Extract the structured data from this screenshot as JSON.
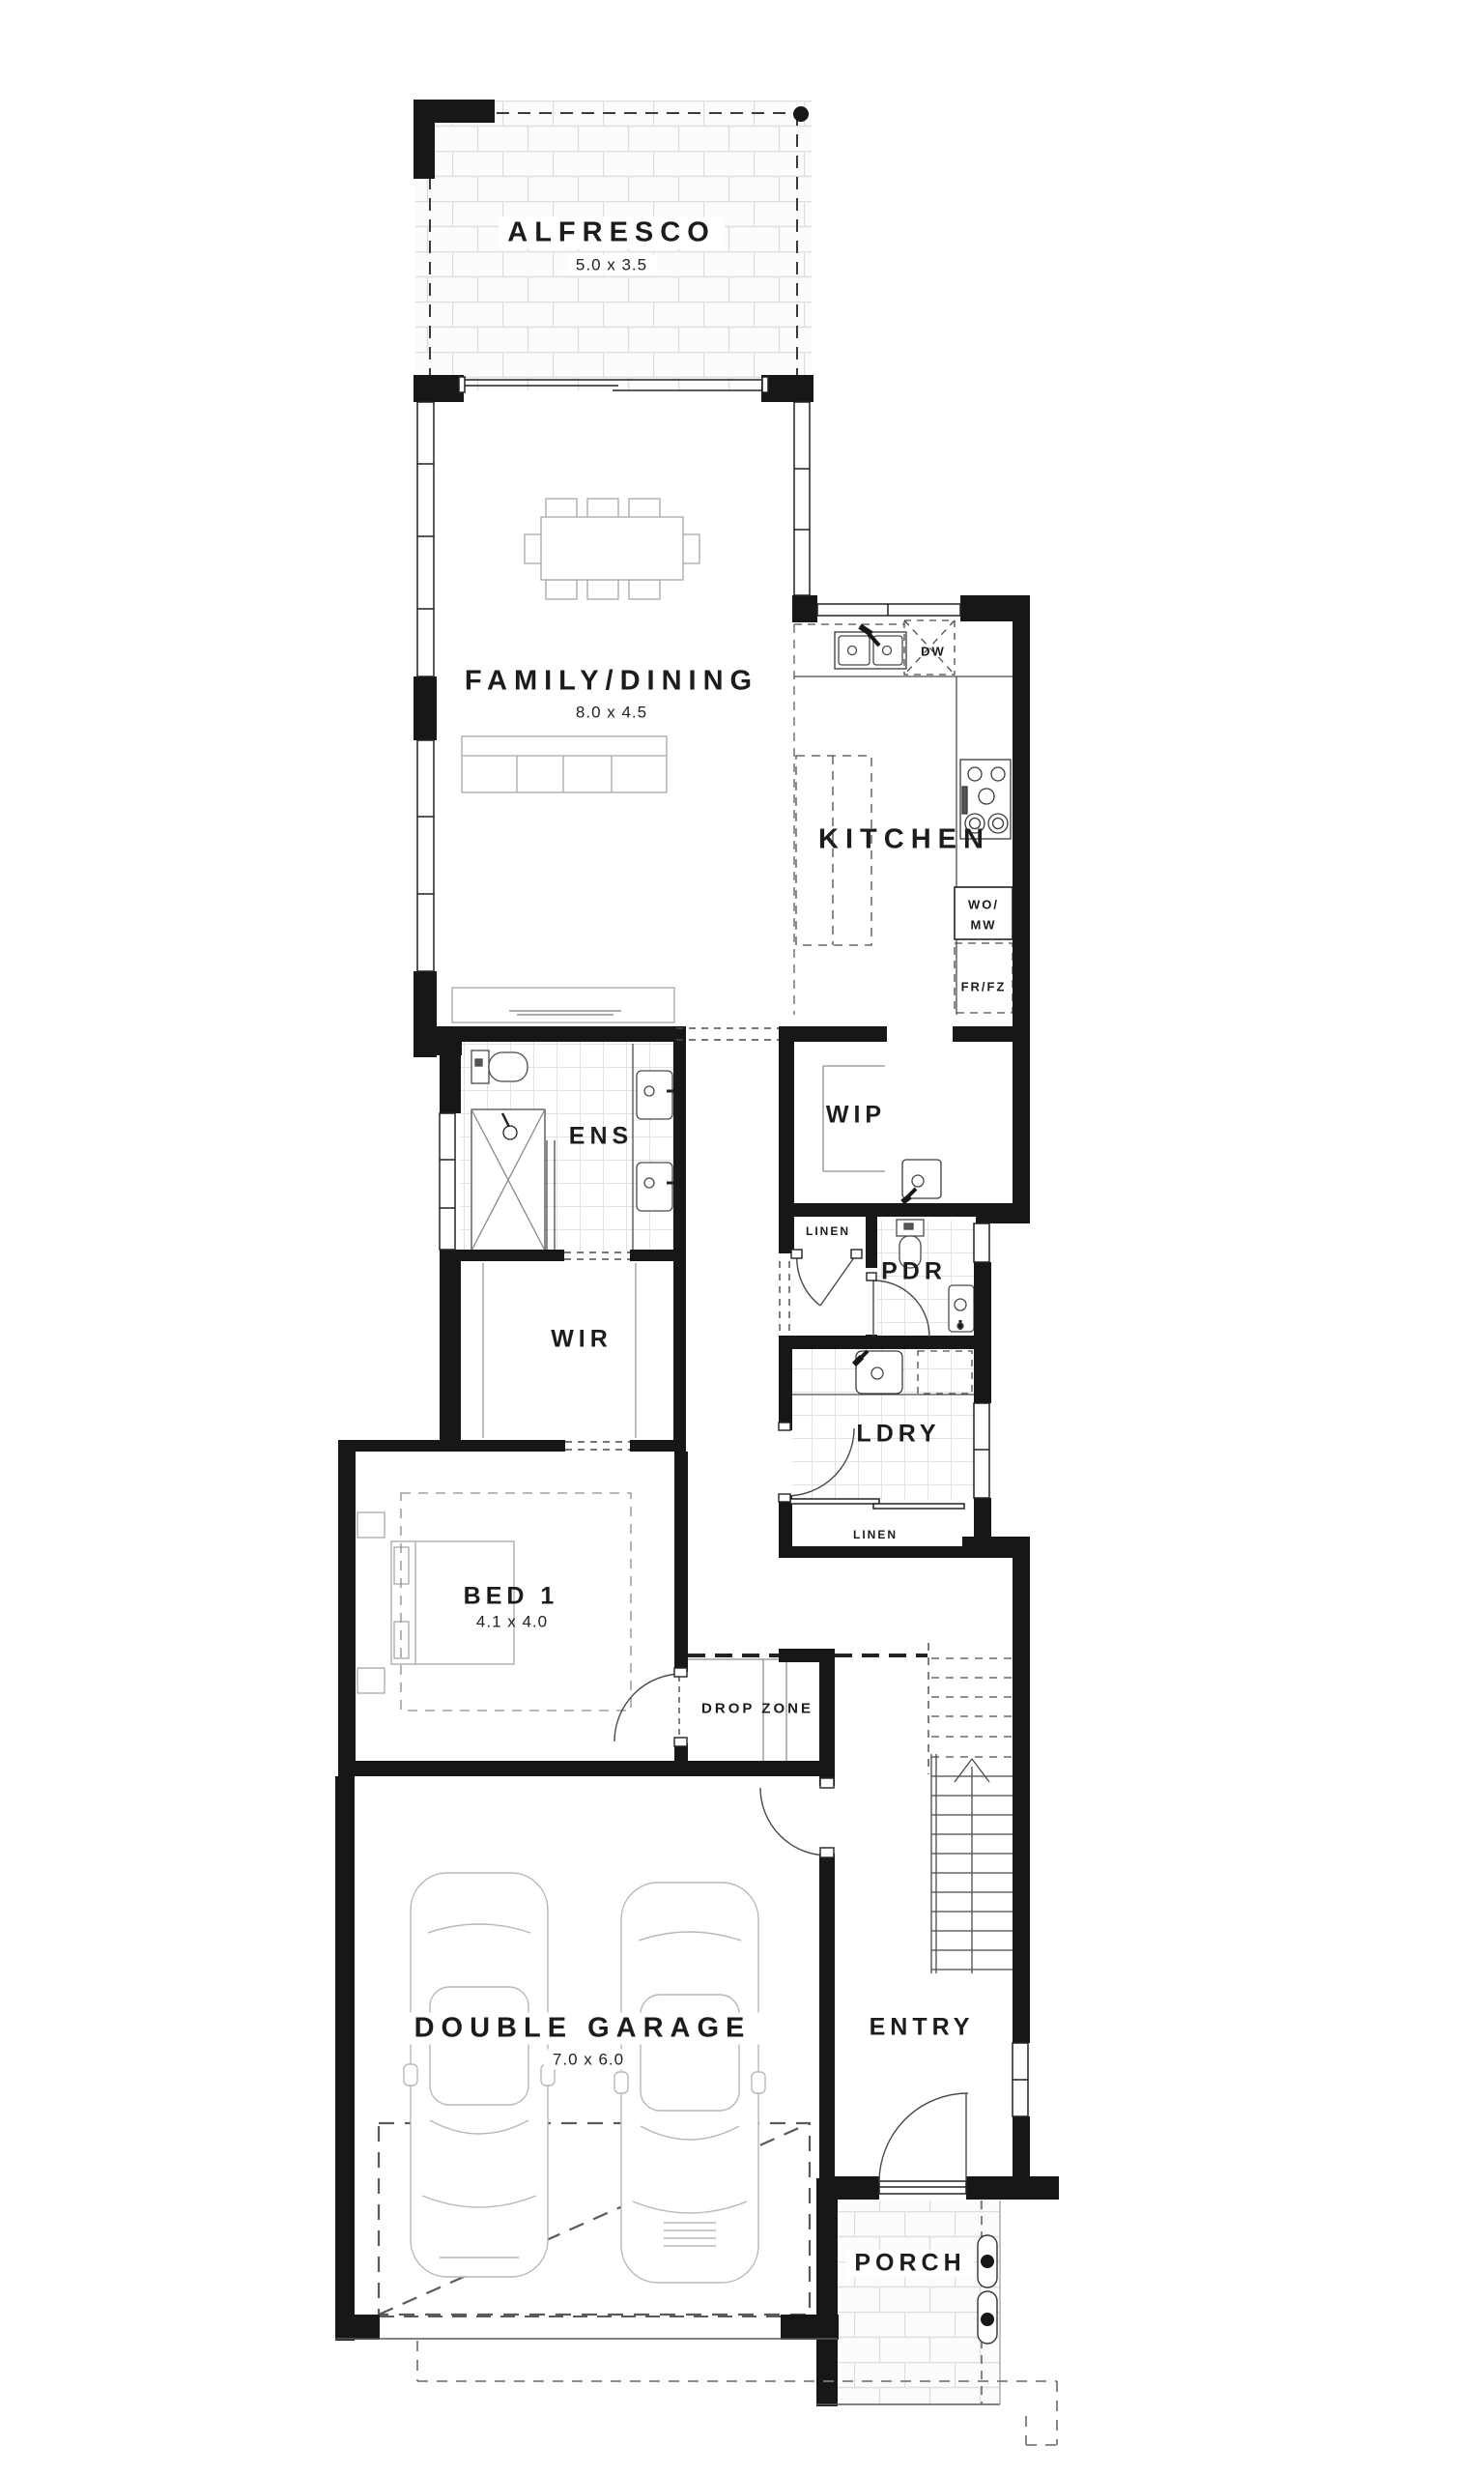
{
  "rooms": {
    "alfresco": {
      "name": "ALFRESCO",
      "dims": "5.0 x 3.5"
    },
    "family": {
      "name": "FAMILY/DINING",
      "dims": "8.0 x 4.5"
    },
    "kitchen": {
      "name": "KITCHEN"
    },
    "wip": {
      "name": "WIP"
    },
    "ens": {
      "name": "ENS"
    },
    "wir": {
      "name": "WIR"
    },
    "pdr": {
      "name": "PDR"
    },
    "ldry": {
      "name": "LDRY"
    },
    "bed1": {
      "name": "BED 1",
      "dims": "4.1 x 4.0"
    },
    "dropzone": {
      "name": "DROP ZONE"
    },
    "garage": {
      "name": "DOUBLE GARAGE",
      "dims": "7.0 x 6.0"
    },
    "entry": {
      "name": "ENTRY"
    },
    "porch": {
      "name": "PORCH"
    }
  },
  "labels": {
    "linen1": "LINEN",
    "linen2": "LINEN",
    "dw": "DW",
    "wo_line1": "WO/",
    "wo_line2": "MW",
    "frfz": "FR/FZ"
  },
  "colors": {
    "wall": "#171717",
    "fixture": "#444444",
    "furniture": "#a8a8a8",
    "brick_joint": "#dedede",
    "tile_joint": "#e2e2e2"
  }
}
